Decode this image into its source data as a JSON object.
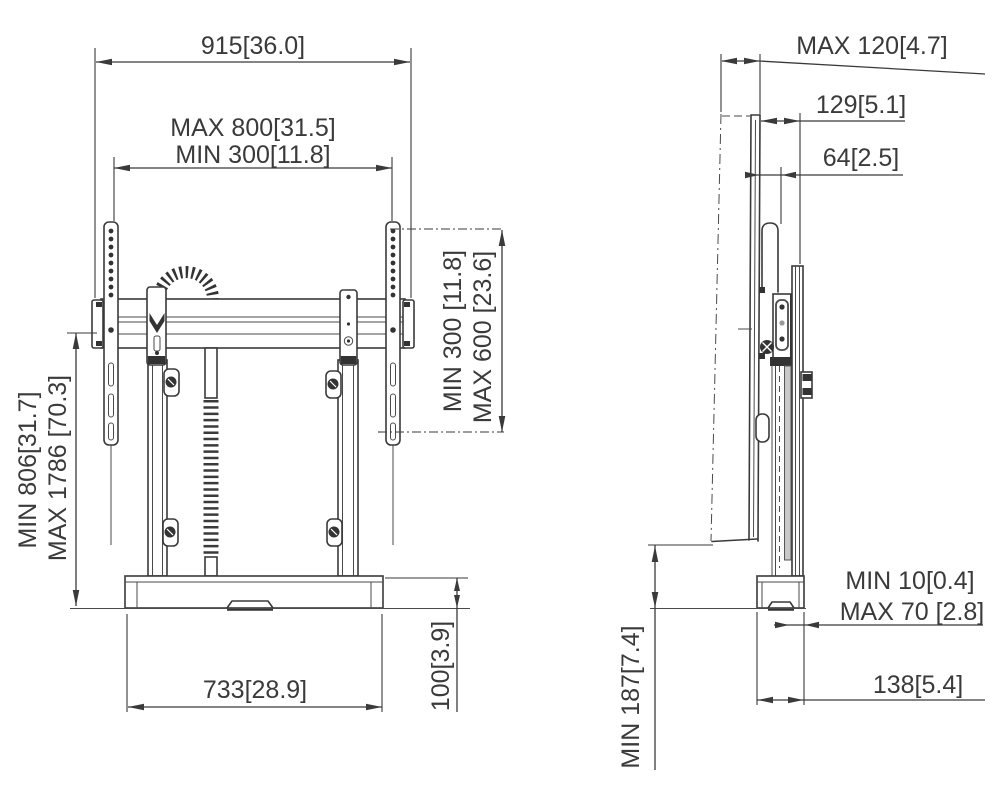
{
  "front_view": {
    "total_width": "915[36.0]",
    "vesa_width_max": "MAX 800[31.5]",
    "vesa_width_min": "MIN 300[11.8]",
    "vesa_height_min": "MIN 300 [11.8]",
    "vesa_height_max": "MAX 600 [23.6]",
    "screen_center_height_min": "MIN 806[31.7]",
    "screen_center_height_max": "MAX 1786 [70.3]",
    "base_width": "733[28.9]",
    "base_height": "100[3.9]"
  },
  "side_view": {
    "tilt_depth_max": "MAX 120[4.7]",
    "depth_129": "129[5.1]",
    "depth_64": "64[2.5]",
    "wall_gap_min": "MIN 10[0.4]",
    "wall_gap_max": "MAX 70 [2.8]",
    "base_depth": "138[5.4]",
    "floor_clearance_min": "MIN 187[7.4]"
  }
}
